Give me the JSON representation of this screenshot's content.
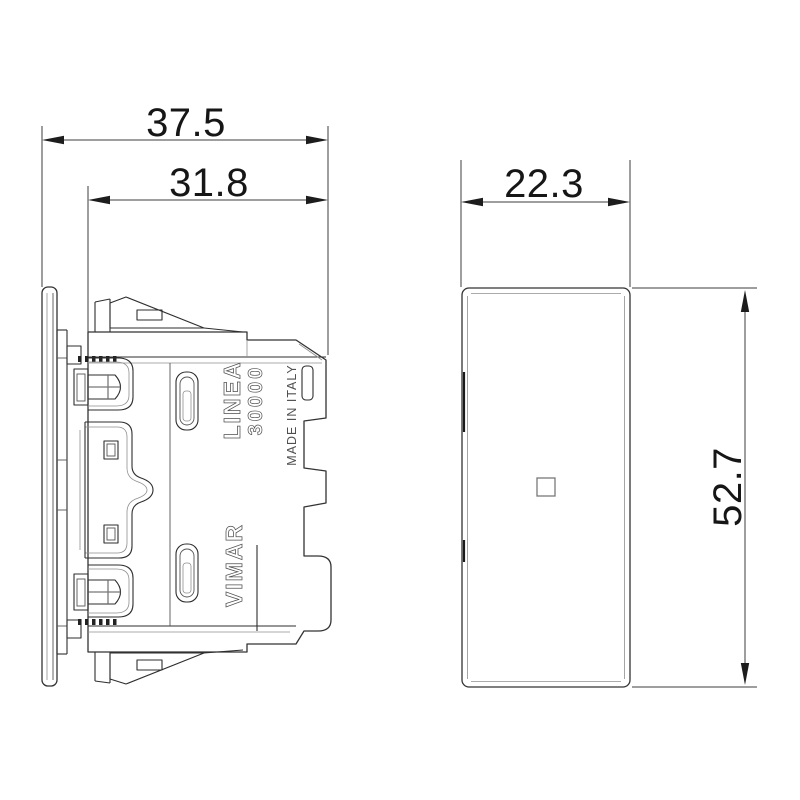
{
  "drawing": {
    "side_view": {
      "dim_overall_depth": "37.5",
      "dim_body_depth": "31.8",
      "marking_series": "LINEA",
      "marking_model": "30000",
      "marking_origin": "MADE IN ITALY",
      "marking_brand": "VIMAR"
    },
    "front_view": {
      "dim_width": "22.3",
      "dim_height": "52.7"
    },
    "colors": {
      "line": "#2e2e2e",
      "light_line": "#8f8f8f",
      "dimension_line": "#3c3c3c",
      "text": "#161616",
      "background": "#ffffff"
    }
  }
}
